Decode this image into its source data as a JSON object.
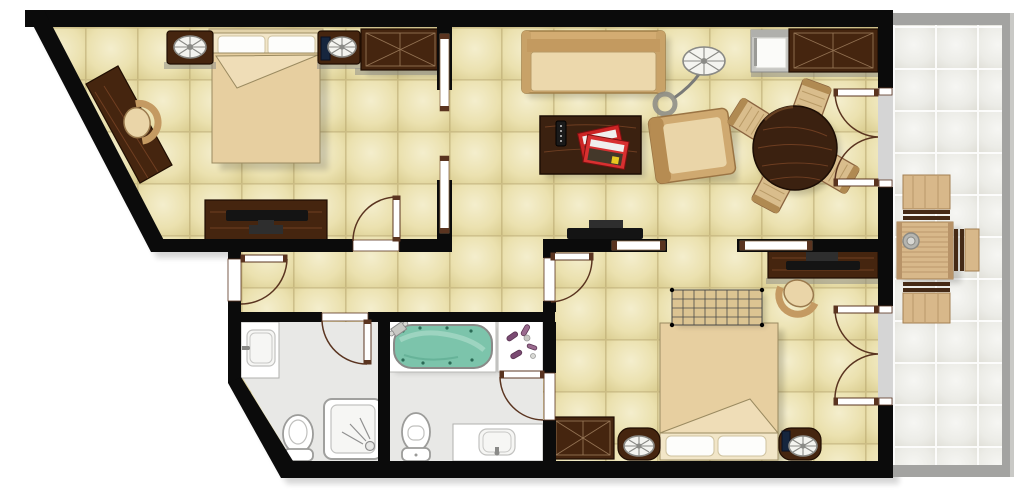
{
  "page": {
    "background": "#ffffff",
    "visible_text": []
  },
  "floor_plan": {
    "type": "residential-suite-floor-plan",
    "rooms": [
      {
        "id": "bedroom-1",
        "furniture": [
          "double-bed",
          "pillow",
          "pillow",
          "nightstand-with-lamp",
          "nightstand-with-lamp",
          "telephone",
          "wardrobe",
          "corner-desk",
          "desk-chair",
          "dresser",
          "television"
        ]
      },
      {
        "id": "living-dining-room",
        "furniture": [
          "sofa",
          "arc-floor-lamp",
          "armchair",
          "coffee-table",
          "tv-remote",
          "magazines",
          "television",
          "round-dining-table",
          "dining-chair",
          "dining-chair",
          "dining-chair",
          "dining-chair",
          "mini-fridge",
          "sideboard-cabinet"
        ]
      },
      {
        "id": "bedroom-2",
        "furniture": [
          "double-bed",
          "pillow",
          "pillow",
          "nightstand-with-lamp",
          "nightstand-with-lamp",
          "telephone",
          "luggage-rack",
          "desk",
          "television",
          "desk-chair",
          "wardrobe"
        ]
      },
      {
        "id": "bathroom-1",
        "furniture": [
          "washbasin",
          "toilet",
          "shower"
        ]
      },
      {
        "id": "bathroom-2",
        "furniture": [
          "jacuzzi-bathtub",
          "bath-faucet",
          "toiletries",
          "toilet",
          "vanity-washbasin"
        ]
      },
      {
        "id": "hallway",
        "furniture": []
      },
      {
        "id": "balcony",
        "furniture": [
          "outdoor-table",
          "ashtray",
          "outdoor-chair",
          "outdoor-chair",
          "outdoor-chair"
        ]
      }
    ],
    "doors": [
      "entry-door",
      "bedroom-1-door",
      "bathroom-1-door",
      "bedroom-2-door",
      "bathroom-2-door",
      "french-door-living-balcony",
      "french-door-bedroom2-balcony"
    ],
    "partitions": [
      "sliding-partition-bedroom1-living",
      "sliding-partition-living-bedroom2"
    ]
  },
  "palette": {
    "wall": "#0b0b0b",
    "floor_hi": "#f4eecd",
    "floor_mid": "#ebe1af",
    "floor_lo": "#dbce92",
    "floor_line": "#b3a169",
    "bath_floor": "#e8e8e6",
    "balcony_hi": "#f6f6f3",
    "balcony_mid": "#ecece7",
    "balcony_lo": "#dfded6",
    "balcony_wall": "#a3a3a1",
    "wood_dark": "#45250f",
    "wood_dark_line": "#200e02",
    "wood_grain": "#7a4526",
    "wood_mid": "#3b2110",
    "wood_light": "#d9bd8c",
    "wood_light_line": "#8a6440",
    "sofa": "#d3ac72",
    "sofa_seat": "#ecd8ac",
    "sofa_line": "#a07e48",
    "blanket": "#e7cfa0",
    "blanket_hi": "#efddb7",
    "sheet": "#f2e6c8",
    "bed_line": "#9a8a60",
    "pillow": "#fdfdfb",
    "pillow_line": "#cfc3a0",
    "fixture_line": "#9c9c9a",
    "water": "#7cc4ab",
    "water_hi": "#abdcc9",
    "water_jet": "#2a6a55",
    "door": "#5a3420",
    "tv": "#141414",
    "tv_mid": "#2e2e2e",
    "magazine_red": "#cc2424",
    "phone": "#16263e",
    "balcony_wood": "#d8b88a",
    "balcony_wood_line": "#a37f52",
    "balcony_rail": "#452a16",
    "grey_band": "#8a8a86",
    "upholstery": "#cfa970",
    "upholstery_hi": "#ead5a8",
    "upholstery_line": "#9a7444"
  }
}
